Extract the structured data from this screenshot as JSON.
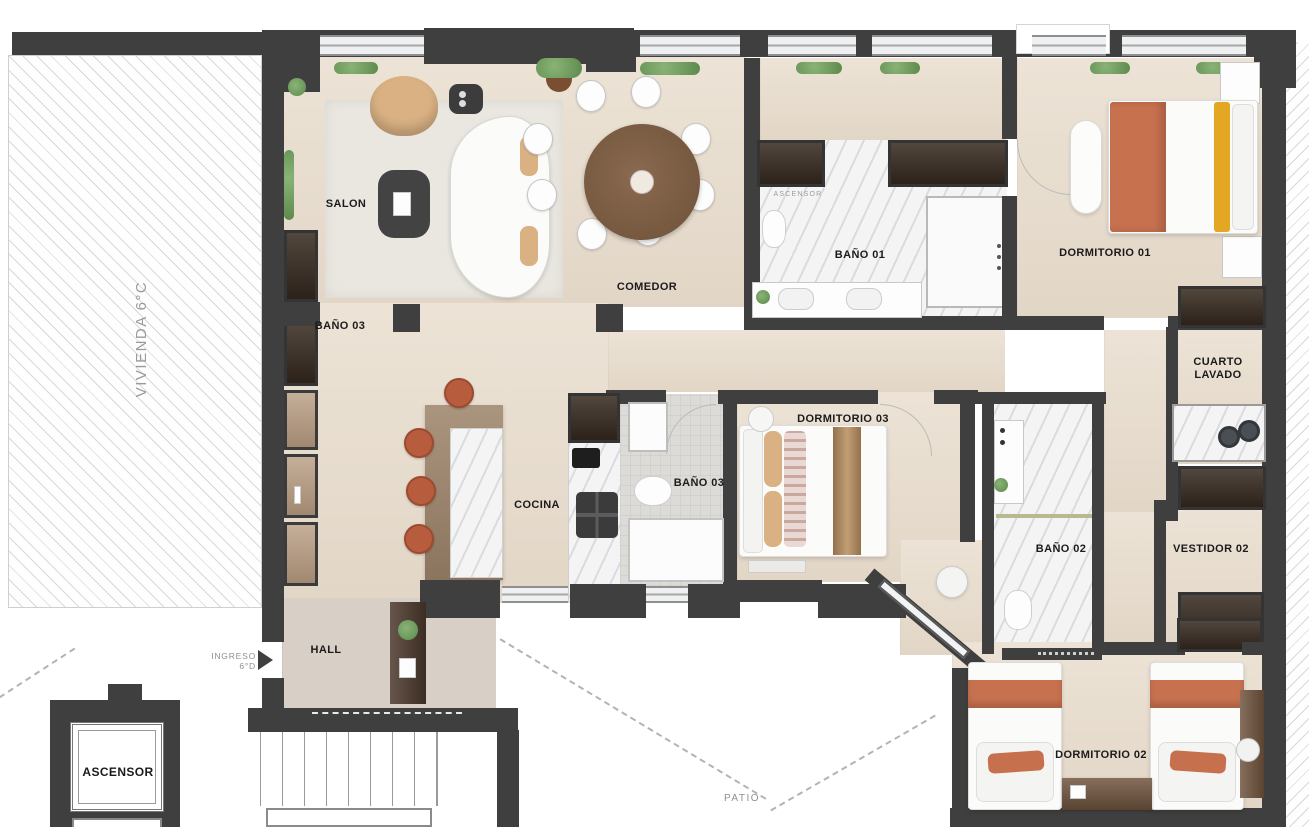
{
  "labels": {
    "adjacent_unit": "VIVIENDA 6°C",
    "salon": "SALON",
    "comedor": "COMEDOR",
    "bano03_upper": "BAÑO 03",
    "bano01": "BAÑO 01",
    "ascensor_shaft": "ASCENSOR",
    "dormitorio01": "DORMITORIO 01",
    "cuarto_lavado_line1": "CUARTO",
    "cuarto_lavado_line2": "LAVADO",
    "cocina": "COCINA",
    "bano03": "BAÑO 03",
    "dormitorio03": "DORMITORIO 03",
    "bano02": "BAÑO 02",
    "vestidor02": "VESTIDOR 02",
    "hall": "HALL",
    "ingreso_line1": "INGRESO",
    "ingreso_line2": "6°D",
    "ascensor": "ASCENSOR",
    "dormitorio02": "DORMITORIO 02",
    "patio": "PATIO"
  },
  "colors": {
    "wall": "#3f3f3f",
    "wood_floor": "#e7ddcf",
    "hall_floor": "#d8d0c6",
    "marble": "#f3f3f4",
    "tile": "#dcdbd7",
    "closet_wood": "#3a2d22",
    "furniture_wood": "#7d5f48",
    "terracotta": "#c7714f",
    "mustard": "#e3a723",
    "tan": "#d9b183",
    "plant_green": "#6f9b5f",
    "rug": "#e9e7e0",
    "label_dark": "#1b1b1b",
    "label_gray": "#909090"
  }
}
